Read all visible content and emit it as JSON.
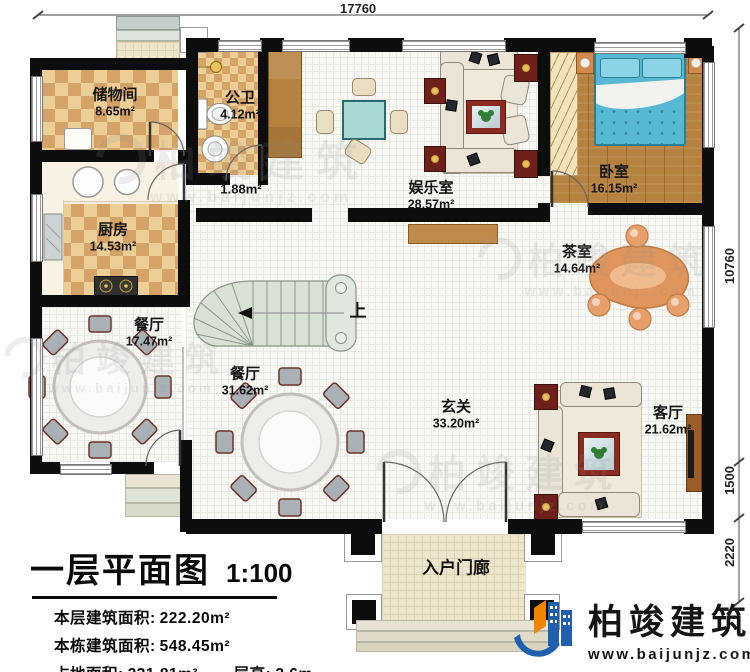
{
  "dimensions": {
    "top": "17760",
    "right_main": "10760",
    "right_mid": "1500",
    "right_bottom": "2220"
  },
  "rooms": [
    {
      "name": "储物间",
      "area": "8.65m²"
    },
    {
      "name": "公卫",
      "area": "4.12m²"
    },
    {
      "name": "厨房",
      "area": "14.53m²"
    },
    {
      "name": "娱乐室",
      "area": "28.57m²"
    },
    {
      "name": "卧室",
      "area": "16.15m²"
    },
    {
      "name": "茶室",
      "area": "14.64m²"
    },
    {
      "name": "餐厅",
      "area": "17.47m²"
    },
    {
      "name": "餐厅",
      "area": "31.62m²"
    },
    {
      "name": "玄关",
      "area": "33.20m²"
    },
    {
      "name": "客厅",
      "area": "21.62m²"
    },
    {
      "name": "入户门廊",
      "area": ""
    }
  ],
  "corridor": {
    "area": "1.88m²"
  },
  "stairs": {
    "up": "上"
  },
  "title_block": {
    "title": "一层平面图",
    "scale": "1:100",
    "area_floor_label": "本层建筑面积:",
    "area_floor_value": "222.20m²",
    "area_total_label": "本栋建筑面积:",
    "area_total_value": "548.45m²",
    "area_land_label": "占地面积:",
    "area_land_value": "231.81m²",
    "height_label": "层高:",
    "height_value": "3.6m"
  },
  "branding": {
    "company": "柏竣建筑",
    "website": "www.baijunjz.com"
  },
  "watermark": {
    "text": "柏竣建筑",
    "url": "www.baijunjz.com"
  },
  "colors": {
    "wall": "#0d0d0d",
    "floor_tan": "#d5a367",
    "bed_blue": "#56b8d2",
    "logo_blue": "#1f5fae",
    "logo_orange": "#f08300"
  }
}
